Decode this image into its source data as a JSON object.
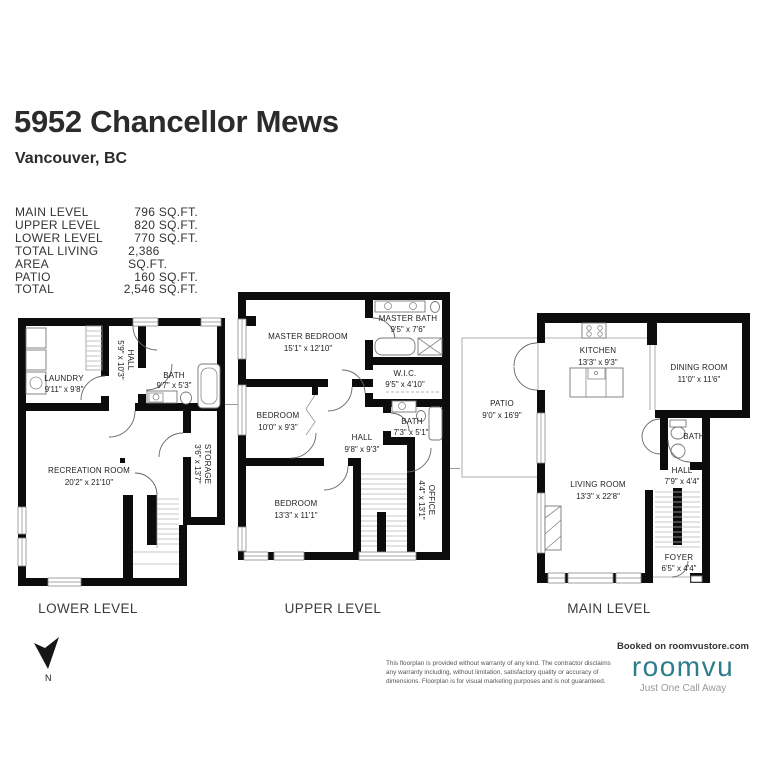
{
  "header": {
    "title": "5952 Chancellor Mews",
    "subtitle": "Vancouver, BC"
  },
  "area_table": {
    "rows": [
      {
        "label": "MAIN LEVEL",
        "value": "796 SQ.FT."
      },
      {
        "label": "UPPER LEVEL",
        "value": "820 SQ.FT."
      },
      {
        "label": "LOWER LEVEL",
        "value": "770 SQ.FT."
      },
      {
        "label": "TOTAL LIVING AREA",
        "value": "2,386 SQ.FT."
      },
      {
        "label": "PATIO",
        "value": "160 SQ.FT."
      },
      {
        "label": "TOTAL",
        "value": "2,546 SQ.FT."
      }
    ]
  },
  "levels": [
    {
      "label": "LOWER LEVEL",
      "rooms": [
        {
          "name": "LAUNDRY",
          "dims": "9'11\" x 9'8\""
        },
        {
          "name": "HALL",
          "dims": "5'9\" x 10'3\""
        },
        {
          "name": "BATH",
          "dims": "9'7\" x 5'3\""
        },
        {
          "name": "RECREATION ROOM",
          "dims": "20'2\" x 21'10\""
        },
        {
          "name": "STORAGE",
          "dims": "3'6\" x 13'7\""
        }
      ]
    },
    {
      "label": "UPPER LEVEL",
      "rooms": [
        {
          "name": "MASTER BEDROOM",
          "dims": "15'1\" x 12'10\""
        },
        {
          "name": "MASTER BATH",
          "dims": "9'5\" x 7'6\""
        },
        {
          "name": "W.I.C.",
          "dims": "9'5\" x 4'10\""
        },
        {
          "name": "BEDROOM",
          "dims": "10'0\" x 9'3\""
        },
        {
          "name": "BATH",
          "dims": "7'3\" x 5'1\""
        },
        {
          "name": "HALL",
          "dims": "9'8\" x 9'3\""
        },
        {
          "name": "BEDROOM",
          "dims": "13'3\" x 11'1\""
        },
        {
          "name": "OFFICE",
          "dims": "4'4\" x 13'1\""
        }
      ]
    },
    {
      "label": "MAIN LEVEL",
      "rooms": [
        {
          "name": "PATIO",
          "dims": "9'0\" x 16'9\""
        },
        {
          "name": "KITCHEN",
          "dims": "13'3\" x 9'3\""
        },
        {
          "name": "DINING ROOM",
          "dims": "11'0\" x 11'6\""
        },
        {
          "name": "BATH",
          "dims": ""
        },
        {
          "name": "LIVING ROOM",
          "dims": "13'3\" x 22'8\""
        },
        {
          "name": "HALL",
          "dims": "7'9\" x 4'4\""
        },
        {
          "name": "FOYER",
          "dims": "6'5\" x 4'4\""
        }
      ]
    }
  ],
  "compass": {
    "label": "N"
  },
  "footer": {
    "disclaimer": "This floorplan is provided without warranty of any kind. The contractor disclaims any warranty including, without limitation, satisfactory quality or accuracy of dimensions. Floorplan is for visual marketing purposes and is not guaranteed.",
    "booked_on": "Booked on roomvustore.com",
    "brand": "roomvu",
    "tagline": "Just One Call Away",
    "brand_color": "#2E7D8C"
  },
  "colors": {
    "wall": "#0c0c0c",
    "background": "#ffffff"
  }
}
